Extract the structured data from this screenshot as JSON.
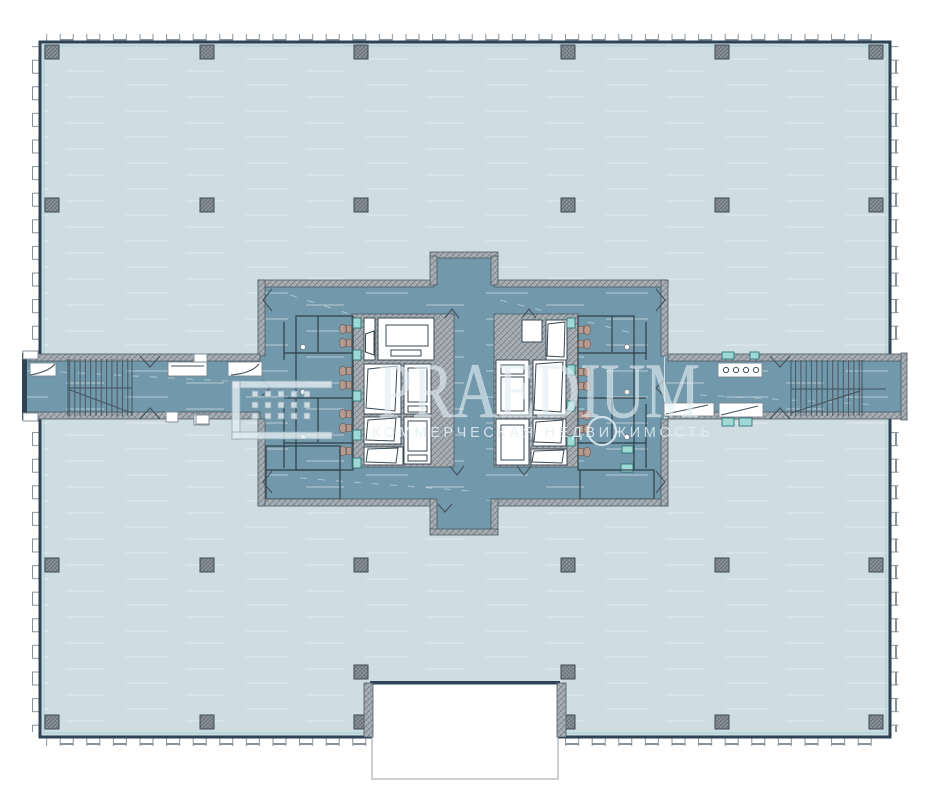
{
  "watermark": {
    "brand": "PRAEDIUM",
    "tagline": "КОММЕРЧЕСКАЯ НЕДВИЖИМОСТЬ",
    "logo_icon": "praedium-grid-bracket-logo"
  },
  "colors": {
    "background": "#ffffff",
    "floor": "#cfdde3",
    "core": "#7198ab",
    "wall": "#2e4456",
    "hatch": "#a9b0b5",
    "teal": "#9fd9d6",
    "fixture": "#b59a8f",
    "watermark": "#e2edf3",
    "trim": "#7cc7c6"
  }
}
